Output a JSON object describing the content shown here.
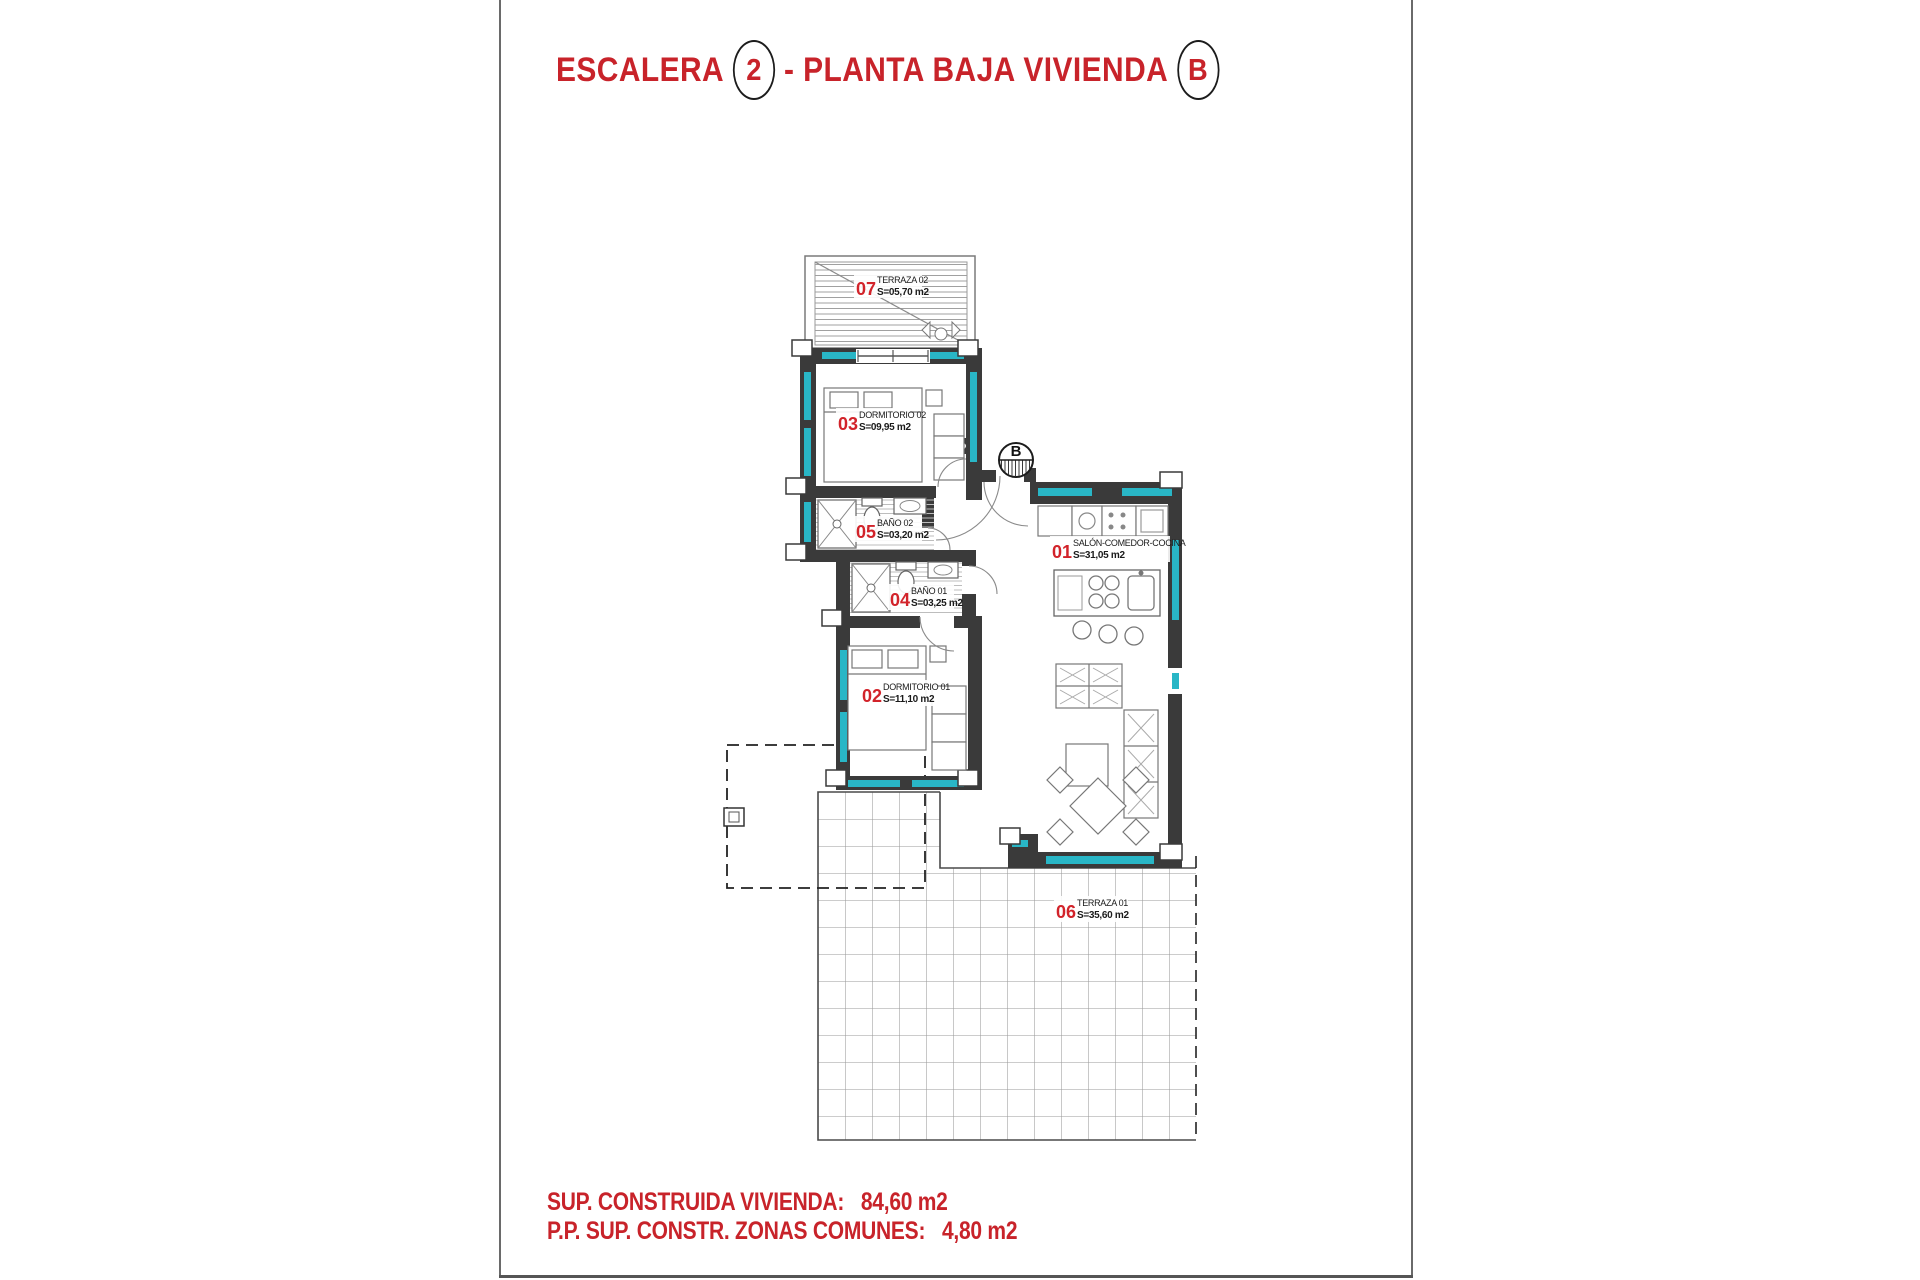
{
  "title": {
    "part1": "ESCALERA",
    "stair_number": "2",
    "part2": "- PLANTA BAJA VIVIENDA",
    "dwelling_letter": "B"
  },
  "stair_symbol": {
    "letter": "B"
  },
  "rooms": [
    {
      "num": "01",
      "name": "SALÓN-COMEDOR-COCINA",
      "area": "S=31,05 m2"
    },
    {
      "num": "02",
      "name": "DORMITORIO 01",
      "area": "S=11,10 m2"
    },
    {
      "num": "03",
      "name": "DORMITORIO 02",
      "area": "S=09,95 m2"
    },
    {
      "num": "04",
      "name": "BAÑO 01",
      "area": "S=03,25 m2"
    },
    {
      "num": "05",
      "name": "BAÑO 02",
      "area": "S=03,20 m2"
    },
    {
      "num": "06",
      "name": "TERRAZA 01",
      "area": "S=35,60 m2"
    },
    {
      "num": "07",
      "name": "TERRAZA 02",
      "area": "S=05,70 m2"
    }
  ],
  "footer": {
    "line1_label": "SUP. CONSTRUIDA VIVIENDA:",
    "line1_value": "84,60 m2",
    "line2_label": "P.P. SUP. CONSTR. ZONAS COMUNES:",
    "line2_value": "4,80 m2"
  },
  "colors": {
    "title_red": "#c8232a",
    "label_red": "#d2232a",
    "wall_dark": "#3a3a3a",
    "insulation_teal": "#29b6c6"
  }
}
